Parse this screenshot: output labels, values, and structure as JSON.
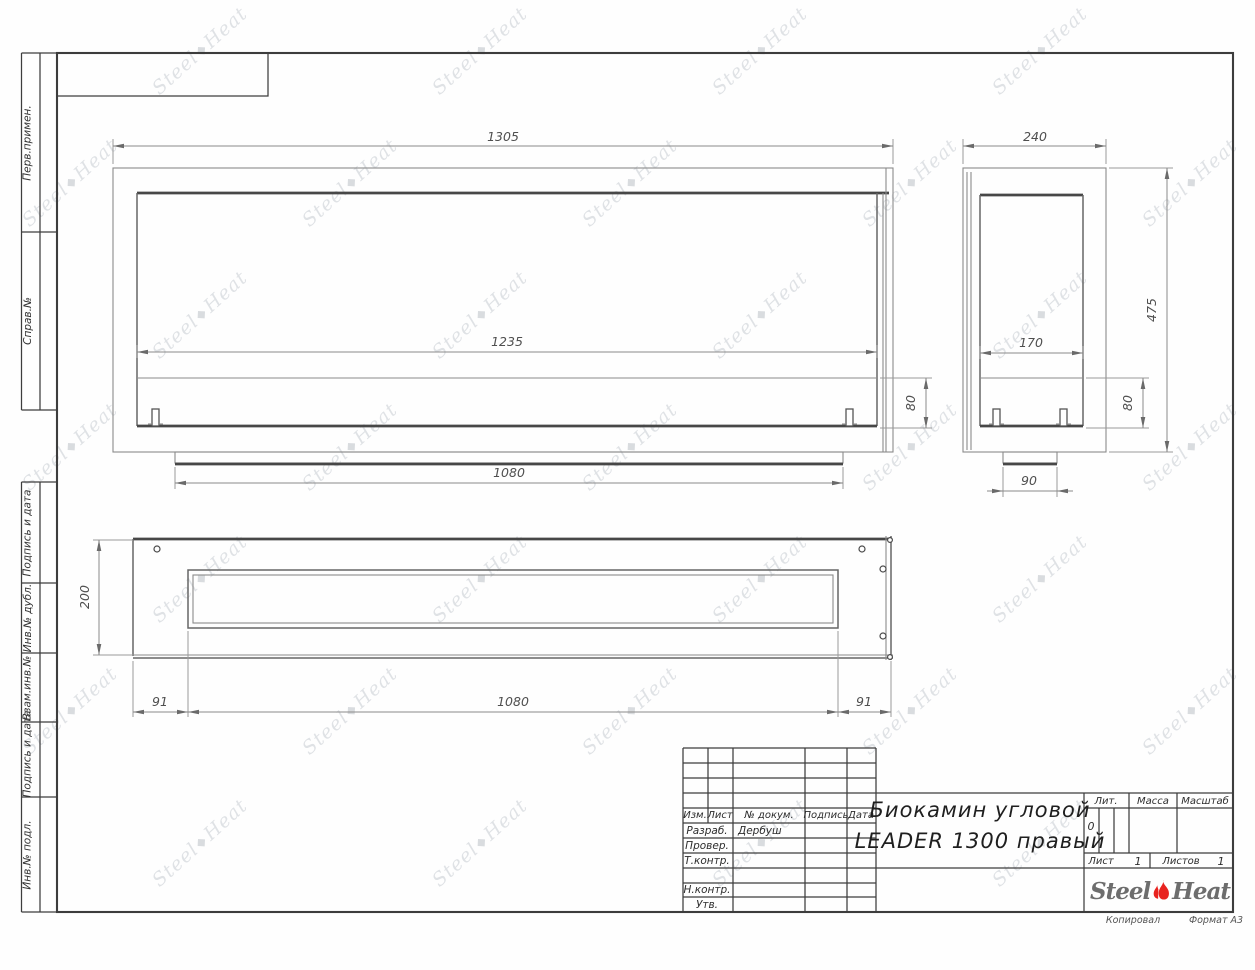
{
  "sheet": {
    "copied_note": "Копировал",
    "format_note": "Формат А3"
  },
  "title_block": {
    "title_line1": "Биокамин угловой",
    "title_line2": "LEADER 1300 правый",
    "header_cols": {
      "izm": "Изм.",
      "list": "Лист",
      "doc_num": "№ докум.",
      "podpis": "Подпись",
      "data": "Дата"
    },
    "rows": {
      "razrab_label": "Разраб.",
      "razrab_value": "Дербуш",
      "prover_label": "Провер.",
      "tkontr_label": "Т.контр.",
      "nkontr_label": "Н.контр.",
      "utv_label": "Утв."
    },
    "lit_label": "Лит.",
    "lit_value": "0",
    "massa_label": "Масса",
    "masshtab_label": "Масштаб",
    "list_label": "Лист",
    "list_value": "1",
    "listov_label": "Листов",
    "listov_value": "1",
    "logo": {
      "steel": "Steel",
      "heat": "Heat"
    }
  },
  "margin_labels": [
    "Перв.примен.",
    "Справ.№",
    "Подпись и дата",
    "Инв.№ дубл.",
    "Взам.инв.№",
    "Подпись и дата",
    "Инв.№ подл."
  ],
  "dimensions": {
    "front": {
      "overall_width": "1305",
      "opening_width": "1235",
      "burner_height": "80",
      "base_width": "1080"
    },
    "side": {
      "overall_depth": "240",
      "overall_height": "475",
      "opening_depth": "170",
      "burner_height": "80",
      "base_depth": "90"
    },
    "top": {
      "overall_depth": "200",
      "left_offset": "91",
      "opening_length": "1080",
      "right_offset": "91"
    }
  },
  "watermark": {
    "steel": "Steel",
    "heat": "Heat"
  },
  "colors": {
    "line_dark": "#474747",
    "line_thin": "#8b8b8b",
    "logo_red": "#e8231f",
    "logo_gray": "#6d6d6d",
    "watermark": "#ccd0d6"
  }
}
